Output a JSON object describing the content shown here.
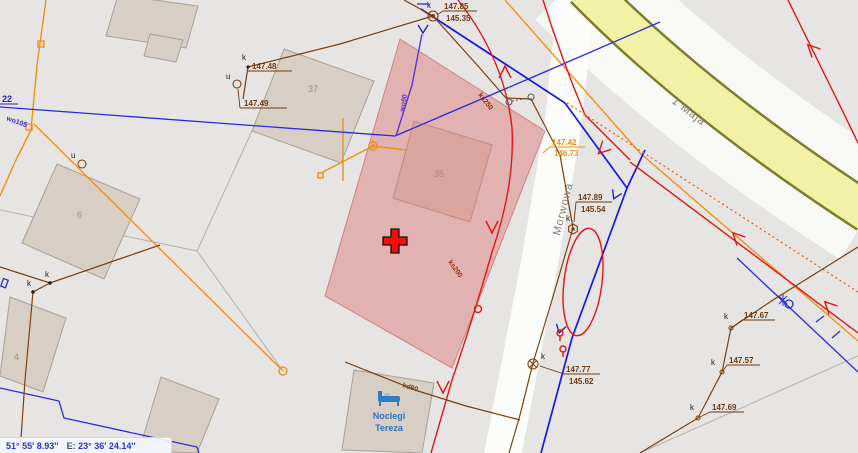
{
  "status_bar": {
    "latitude": "51° 55' 8.93''",
    "lon_label": "E:",
    "longitude": "23° 36' 24.14''"
  },
  "streets": {
    "vertical": "Morwowa",
    "diagonal": "1 Maja"
  },
  "poi": {
    "line1": "Noclegi",
    "line2": "Tereza"
  },
  "parcel_numbers": {
    "left_edge": "22"
  },
  "buildings": {
    "b37": "37",
    "b35": "35",
    "b6": "6",
    "b4": "4"
  },
  "elevations": {
    "e1": {
      "top": "147.85",
      "bottom": "145.35"
    },
    "e2": {
      "top": "147.48"
    },
    "e3": {
      "top": "147.49"
    },
    "e4": {
      "top": "147.42",
      "bottom": "146.73"
    },
    "e5": {
      "top": "147.89",
      "bottom": "145.54"
    },
    "e6": {
      "top": "147.77",
      "bottom": "145.62"
    },
    "e7": {
      "top": "147.67"
    },
    "e8": {
      "top": "147.57"
    },
    "e9": {
      "top": "147.69"
    }
  },
  "utility_labels": {
    "wo105": "wo105",
    "wo90": "wo90",
    "ks250": "ks250",
    "ks200": "ks200",
    "kd80": "kd80"
  },
  "markers": {
    "k": "k",
    "u": "u"
  },
  "colors": {
    "selected_parcel": "#e9aaa8",
    "water_line": "#2b2be0",
    "sewer_line": "#e31313",
    "power_line": "#f29111",
    "telecom_line": "#7c4012",
    "boundary_line": "#1717e8",
    "road_fill": "#f2f2a6",
    "cross_marker": "#ef0f0f"
  }
}
